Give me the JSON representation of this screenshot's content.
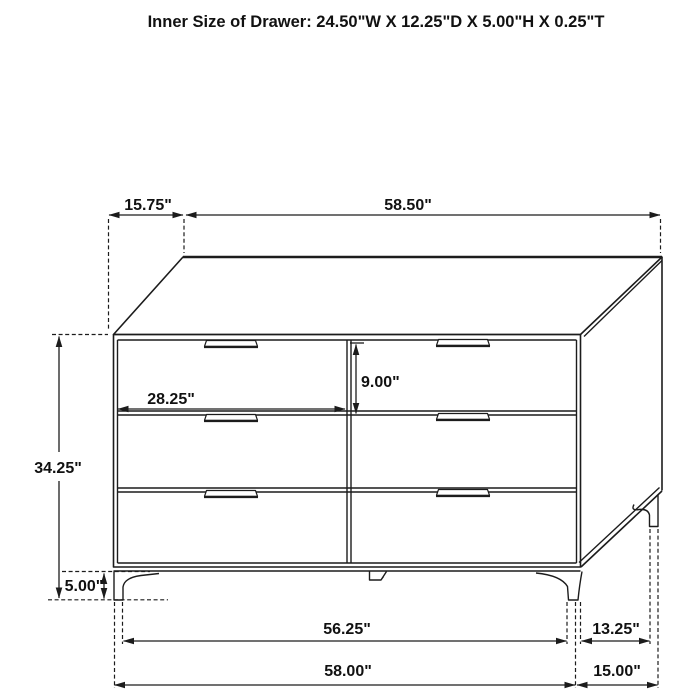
{
  "title": "Inner Size of Drawer: 24.50\"W X 12.25\"D X 5.00\"H X 0.25\"T",
  "diagram_subject": "six-drawer dresser dimension drawing",
  "dimensions": {
    "top_depth": "15.75\"",
    "top_width": "58.50\"",
    "drawer_front_width": "28.25\"",
    "drawer_front_height": "9.00\"",
    "overall_height": "34.25\"",
    "leg_height": "5.00\"",
    "leg_span_width": "56.25\"",
    "leg_span_depth": "13.25\"",
    "overall_width": "58.00\"",
    "overall_depth": "15.00\""
  },
  "colors": {
    "background": "#ffffff",
    "line": "#1c1c1c",
    "text": "#111111"
  }
}
